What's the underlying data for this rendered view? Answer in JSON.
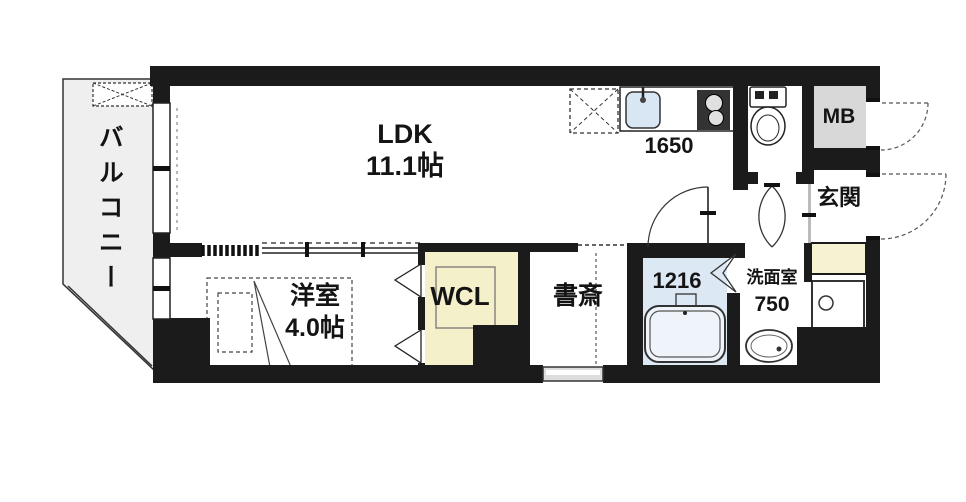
{
  "rooms": {
    "balcony": {
      "label": "バルコニー"
    },
    "ldk": {
      "label": "LDK",
      "size": "11.1帖"
    },
    "kitchen": {
      "counter_width": "1650"
    },
    "western_room": {
      "label": "洋室",
      "size": "4.0帖"
    },
    "walk_in_closet": {
      "label": "WCL"
    },
    "study": {
      "label": "書斎"
    },
    "bathroom": {
      "unit_size": "1216"
    },
    "washroom": {
      "label": "洗面室",
      "size": "750"
    },
    "meter_box": {
      "label": "MB"
    },
    "entrance": {
      "label": "玄関"
    }
  },
  "colors": {
    "wall": "#1b1b1b",
    "balcony_fill": "#efefef",
    "bathroom_fill": "#dce8f3",
    "bathtub_fill": "#eef4fa",
    "closet_fill": "#f4f0ca",
    "shoe_cabinet_fill": "#f6f3d2",
    "meter_box_fill": "#d8d8d8",
    "sink_fill": "#d9e6f3",
    "stove_fill": "#333333"
  }
}
